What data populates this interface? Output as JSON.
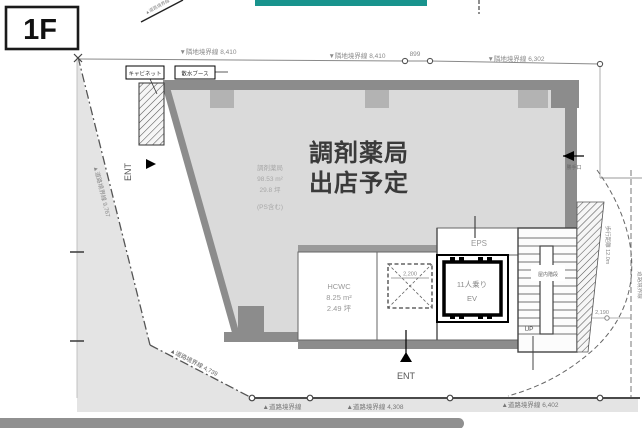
{
  "floor_label": "1F",
  "top_dims": {
    "d1": "▼隣地境界線 8,410",
    "d2": "▼隣地境界線 8,410",
    "d3": "899",
    "d4": "▼隣地境界線 6,302"
  },
  "left_dims": {
    "road1": "▲道路境界線 9,767",
    "road2": "▲道路境界線 4,739"
  },
  "bottom_dims": {
    "b1": "▲道路境界線",
    "b2": "▲道路境界線 4,308",
    "b3": "▲道路境界線 6,402"
  },
  "right_side": {
    "back_door": "勝手口",
    "walking_distance": "歩行距離 12.0m",
    "boundary": "道路境界線",
    "dim": "2,190"
  },
  "topleft_boundary": "▲道路境界線",
  "tenant": {
    "line1": "調剤薬局",
    "line2": "出店予定",
    "info_name": "調剤薬局",
    "info_area": "98.53 m²",
    "info_tsubo": "29.8 坪",
    "info_note": "(PS含む)"
  },
  "rooms": {
    "eps": "EPS",
    "hcwc_name": "HCWC",
    "hcwc_area": "8.25 m²",
    "hcwc_tsubo": "2.49 坪",
    "ev_line1": "11人乗り",
    "ev_line2": "EV",
    "ps_dim": "2,200",
    "stair_up": "UP",
    "stair_note": "屋内階段"
  },
  "entrances": {
    "left": "ENT",
    "bottom": "ENT"
  },
  "equipment": {
    "cabinet": "キャビネット",
    "water_booth": "散水ブース"
  },
  "colors": {
    "accent_teal": "#18938d",
    "floor_gray": "#dadada",
    "road_gray": "#e4e4e4",
    "wall_gray": "#8c8c8c"
  }
}
